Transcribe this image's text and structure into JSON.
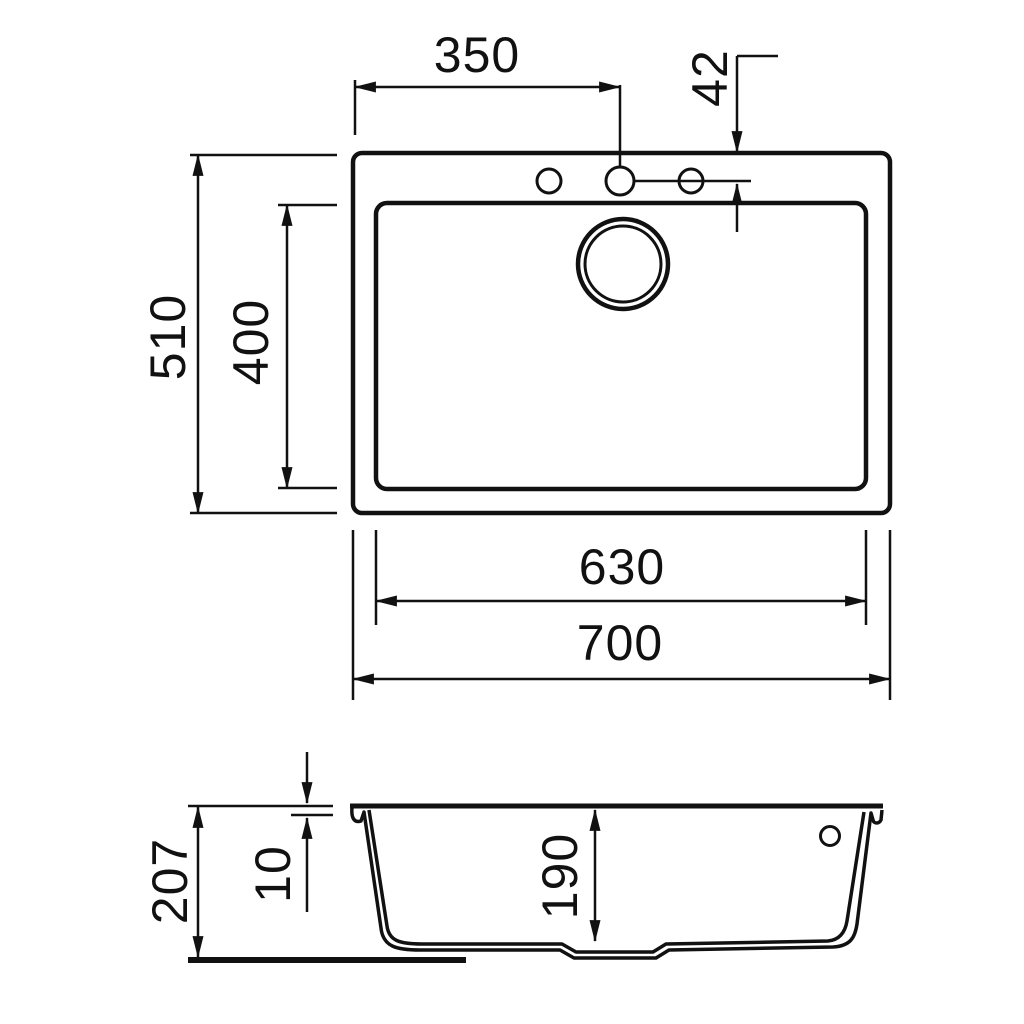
{
  "drawing": {
    "kind": "sink-dimension-drawing",
    "line_color": "#111111",
    "background_color": "#ffffff"
  },
  "dimensions": {
    "tap_hole_offset_x": "350",
    "tap_hole_offset_y": "42",
    "overall_depth": "510",
    "bowl_depth_plan": "400",
    "bowl_width": "630",
    "overall_width": "700",
    "overall_height": "207",
    "rim_height": "10",
    "bowl_depth_section": "190"
  }
}
